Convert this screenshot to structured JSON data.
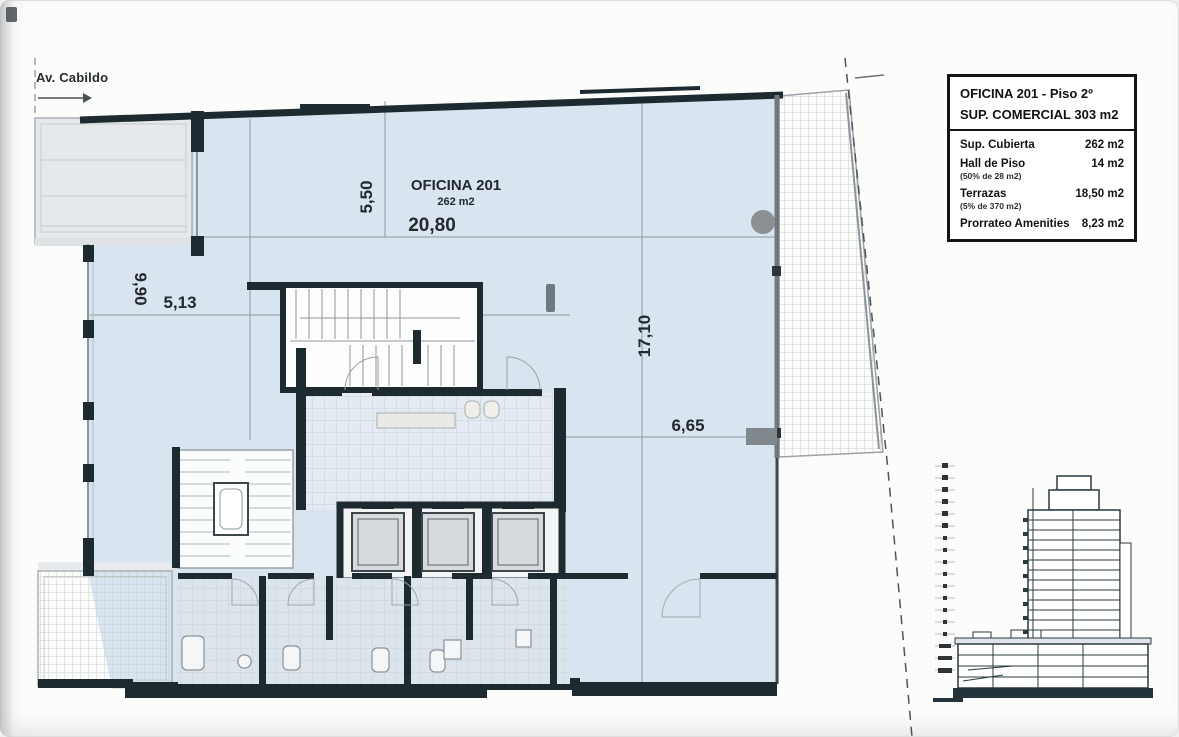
{
  "street": {
    "label": "Av. Cabildo"
  },
  "plan": {
    "room": {
      "name": "OFICINA 201",
      "area": "262 m2"
    },
    "dims": {
      "top_width": "20,80",
      "top_depth": "5,50",
      "left_height": "9,90",
      "left_width": "5,13",
      "right_height": "17,10",
      "right_width": "6,65"
    }
  },
  "info_box": {
    "title": "OFICINA 201 - Piso 2º",
    "subtitle": "SUP. COMERCIAL  303 m2",
    "rows": [
      {
        "label": "Sup. Cubierta",
        "note": "",
        "value": "262 m2"
      },
      {
        "label": "Hall de Piso",
        "note": "(50% de 28 m2)",
        "value": "14 m2"
      },
      {
        "label": "Terrazas",
        "note": "(5% de 370 m2)",
        "value": "18,50 m2"
      },
      {
        "label": "Prorrateo Amenities",
        "note": "",
        "value": "8,23 m2"
      }
    ]
  },
  "colors": {
    "wall": "#1d2b30",
    "office_fill": "#d8e4ef",
    "hatch_fill": "#ebedee",
    "dim_line": "#9099a0"
  }
}
